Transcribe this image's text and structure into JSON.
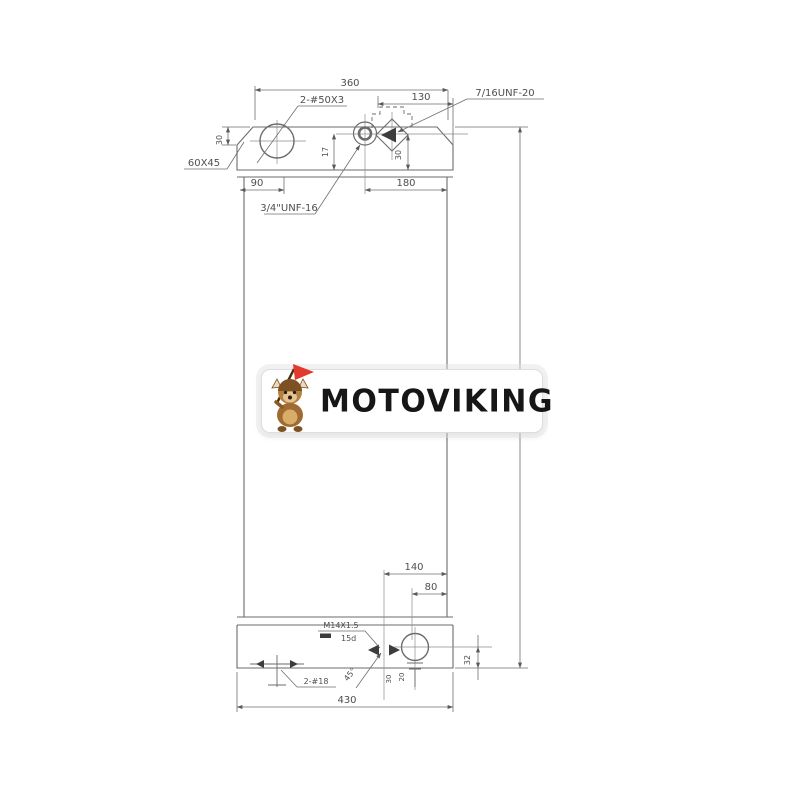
{
  "page": {
    "background": "#ffffff"
  },
  "logo": {
    "text": "MOTOVIKING",
    "mascot_icon": "viking-dog-mascot",
    "colors": {
      "text": "#161616",
      "pill_bg": "#ffffff",
      "flag": "#e23a2e",
      "fur": "#a06a32"
    }
  },
  "drawing": {
    "line_color": "#6b6b6b",
    "dims": {
      "top_width": "360",
      "top_right_width": "130",
      "caps_label": "2-#50X3",
      "top_right_thread": "7/16UNF-20",
      "chamfer_label": "60X45",
      "chamfer_height": "30",
      "port_offset_17": "17",
      "port_offset_30": "30",
      "left_offset_90": "90",
      "right_offset_180": "180",
      "center_thread": "3/4\"UNF-16",
      "bottom_width_140": "140",
      "bottom_width_80": "80",
      "drain_thread": "M14X1.5",
      "drain_depth": "15d",
      "bottom_ports_label": "2-#18",
      "angle_45": "45°",
      "right_offset_32": "32",
      "stem_30": "30",
      "stem_20": "20",
      "overall_width": "430"
    }
  }
}
